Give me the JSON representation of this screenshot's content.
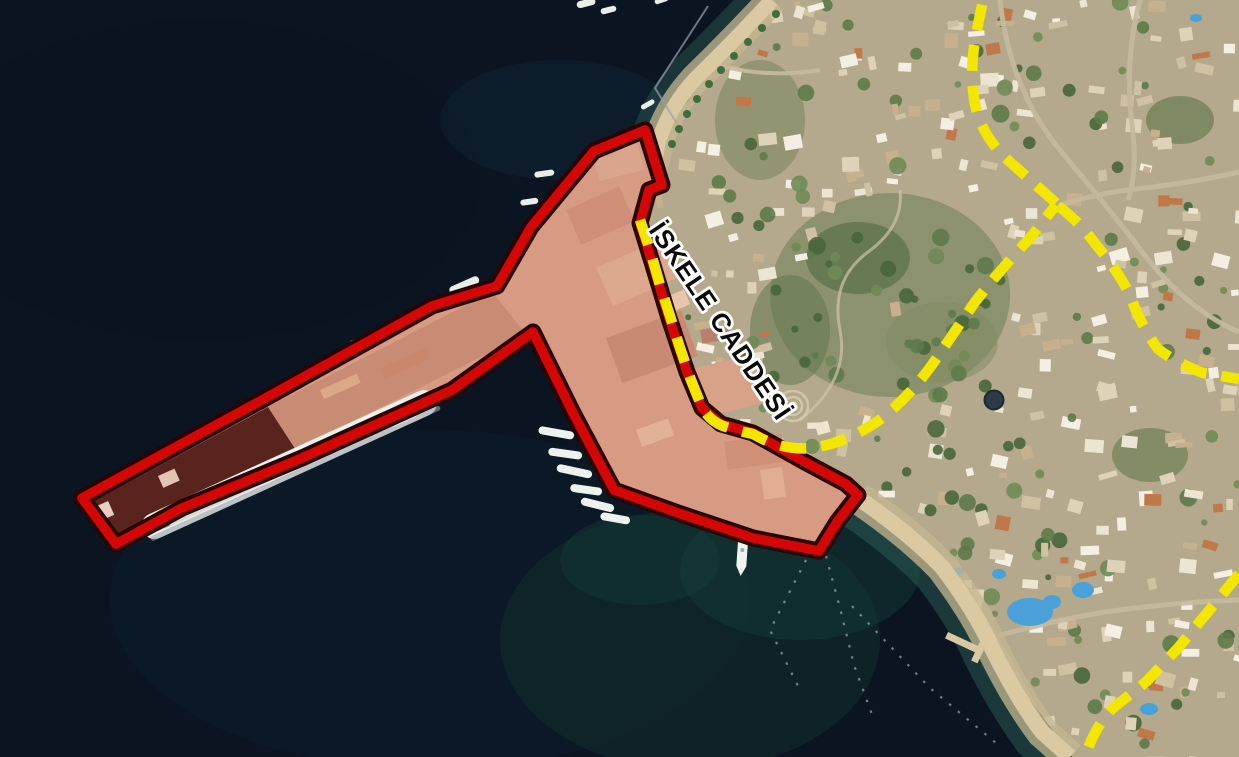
{
  "map": {
    "street_label": "İSKELE CADDESİ",
    "label_transform": "translate(648,230) rotate(56)",
    "colors": {
      "sea_deep": "#0b1522",
      "sea_bay": "#12302c",
      "land_base": "#b4a98c",
      "beach_sand": "#dbc9a1",
      "port_fill": "#d79a82",
      "pier_dark": "#511d17",
      "boundary_red": "#d40606",
      "boundary_dark_edge": "#2a0404",
      "route_yellow": "#f3e600",
      "ship_white": "#eef2ef",
      "pool_blue": "#4aa0d8",
      "vegetation_green": "#5d7a4a",
      "label_fill": "#0a0a0a",
      "label_outline": "#ffffff"
    },
    "port_outline_path": "M 82 498 L 262 400 L 432 306 L 497 286 L 531 227 L 594 151 L 645 130 L 662 185 L 649 190 L 640 223 L 652 262 L 669 318 L 687 372 L 702 408 L 721 424 L 753 433 L 803 461 L 846 484 L 858 495 L 837 522 L 819 551 L 753 538 L 681 514 L 614 490 L 573 413 L 533 332 L 452 390 L 302 458 L 182 508 L 116 544 Z",
    "route_main_path": "M 640 220 L 650 250 L 660 285 L 670 316 L 680 348 L 691 380 L 701 405 Q 708 420 723 426 Q 738 431 753 434 Q 782 451 812 448 Q 846 443 878 421 Q 908 399 934 362 L 975 302 Q 1000 270 1030 238 L 1056 205 M 1056 203 Q 1036 185 1010 162 Q 984 139 976 109 Q 969 78 975 40 L 983 0 M 1058 206 Q 1078 220 1097 246 Q 1116 268 1129 293 Q 1141 326 1158 349 Q 1175 362 1203 373 L 1239 379",
    "route_south_path": "M 1239 574 L 1212 607 L 1178 648 L 1146 682 L 1113 708 Q 1095 726 1085 757"
  }
}
